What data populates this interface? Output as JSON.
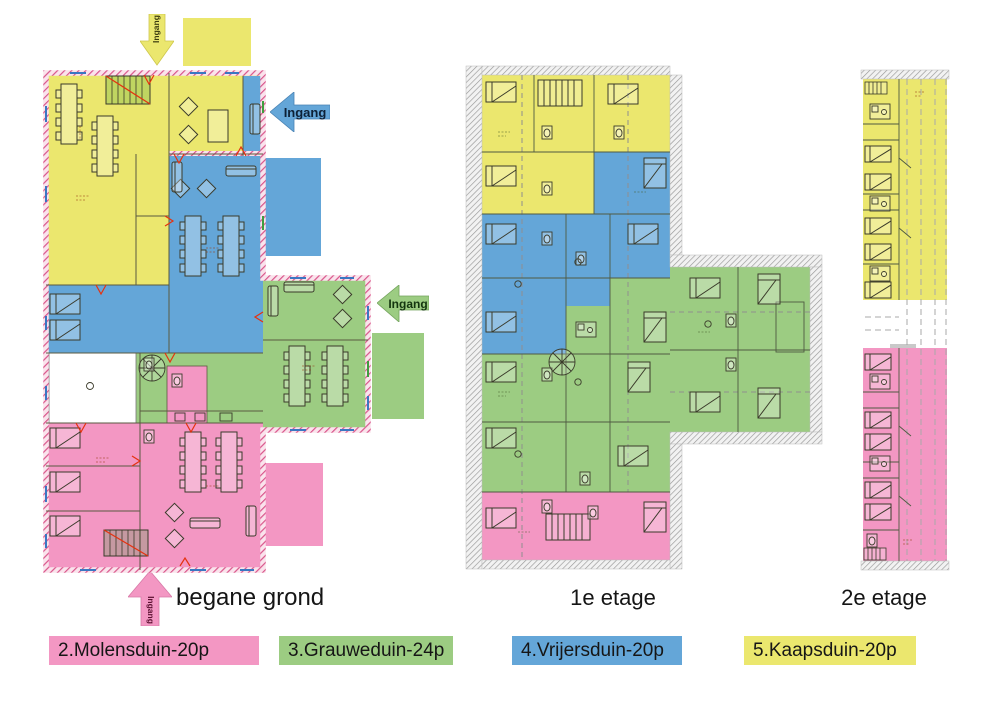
{
  "entrance_label": "Ingang",
  "floors": {
    "ground": {
      "label": "begane grond"
    },
    "first": {
      "label": "1e etage"
    },
    "second": {
      "label": "2e etage"
    }
  },
  "legend": {
    "items": [
      {
        "id": "molensduin",
        "label": "2.Molensduin-20p",
        "color": "#F397C3"
      },
      {
        "id": "grauweduin",
        "label": "3.Grauweduin-24p",
        "color": "#9CCC82"
      },
      {
        "id": "vrijersduin",
        "label": "4.Vrijersduin-20p",
        "color": "#64A6D8"
      },
      {
        "id": "kaapsduin",
        "label": "5.Kaapsduin-20p",
        "color": "#EBE76E"
      }
    ]
  },
  "colors": {
    "pink": "#F397C3",
    "green": "#9CCC82",
    "blue": "#64A6D8",
    "yellow": "#EBE76E",
    "wall_hatch_pink": "#D9548A",
    "roof_hatch_gray": "#909090",
    "door_red": "#E5320F",
    "white_room": "#FFFFFF"
  }
}
